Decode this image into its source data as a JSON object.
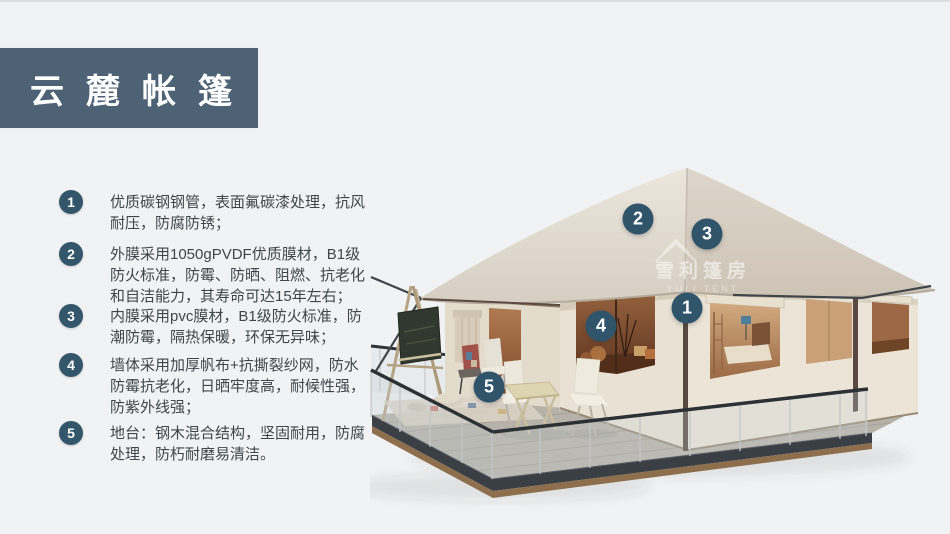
{
  "banner": {
    "title": "云麓帐篷",
    "bg_color": "#4d6375",
    "text_color": "#ffffff"
  },
  "features": [
    {
      "number": "1",
      "text": "优质碳钢钢管，表面氟碳漆处理，抗风耐压，防腐防锈；"
    },
    {
      "number": "2",
      "text": "外膜采用1050gPVDF优质膜材，B1级防火标准，防霉、防晒、阻燃、抗老化和自洁能力，其寿命可达15年左右；"
    },
    {
      "number": "3",
      "text": "内膜采用pvc膜材，B1级防火标准，防潮防霉，隔热保暖，环保无异味；"
    },
    {
      "number": "4",
      "text": "墙体采用加厚帆布+抗撕裂纱网，防水防霉抗老化，日晒牢度高，耐候性强，防紫外线强；"
    },
    {
      "number": "5",
      "text": "地台：钢木混合结构，坚固耐用，防腐处理，防朽耐磨易清洁。"
    }
  ],
  "markers": [
    {
      "label": "1"
    },
    {
      "label": "2"
    },
    {
      "label": "3"
    },
    {
      "label": "4"
    },
    {
      "label": "5"
    }
  ],
  "watermark": {
    "line1": "雪利篷房",
    "line2": "YULI TENT"
  },
  "colors": {
    "page_bg": "#f1f2f3",
    "banner_bg": "#4d6375",
    "badge_slate": "#33566b",
    "body_text": "#3e4649"
  }
}
